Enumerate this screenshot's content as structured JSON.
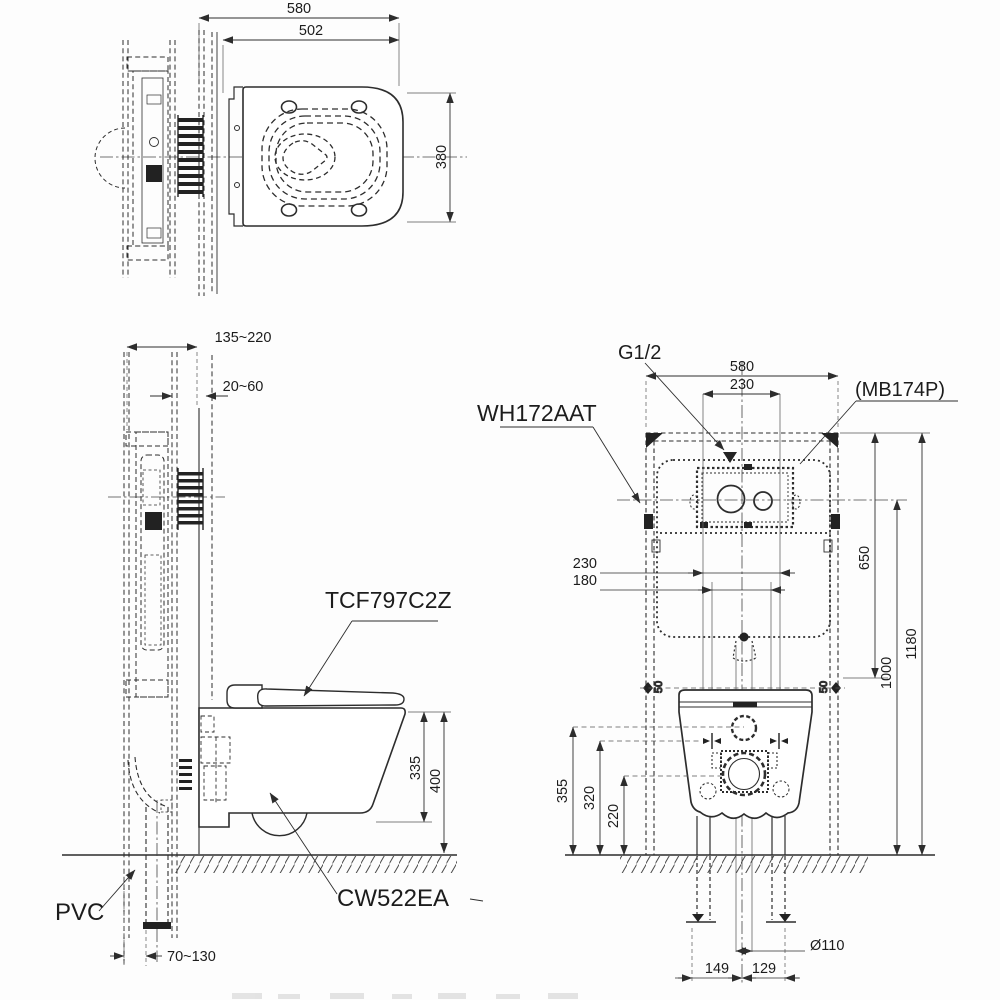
{
  "title": "Wall-hung toilet installation drawing",
  "plan": {
    "overall_width": "580",
    "seat_depth": "502",
    "bowl_width": "380"
  },
  "side": {
    "frame_depth_range": "135~220",
    "wall_finish_range": "20~60",
    "rim_height": "335",
    "seat_height": "400",
    "outlet_offset_range": "70~130",
    "washlet_label": "TCF797C2Z",
    "bowl_label": "CW522EA",
    "pipe_label": "PVC"
  },
  "front": {
    "frame_label": "WH172AAT",
    "plate_label": "(MB174P)",
    "supply_label": "G1/2",
    "frame_width": "580",
    "supply_offset": "230",
    "span_wide": "230",
    "span_narrow": "180",
    "tank_drop": "650",
    "actuator_height": "1000",
    "frame_height": "1180",
    "rim_line": "355",
    "bolt_line": "320",
    "drain_line": "220",
    "edge_gap_left": "50",
    "edge_gap_right": "50",
    "drain_diameter": "Ø110",
    "foot_offset_left": "149",
    "foot_offset_right": "129"
  }
}
